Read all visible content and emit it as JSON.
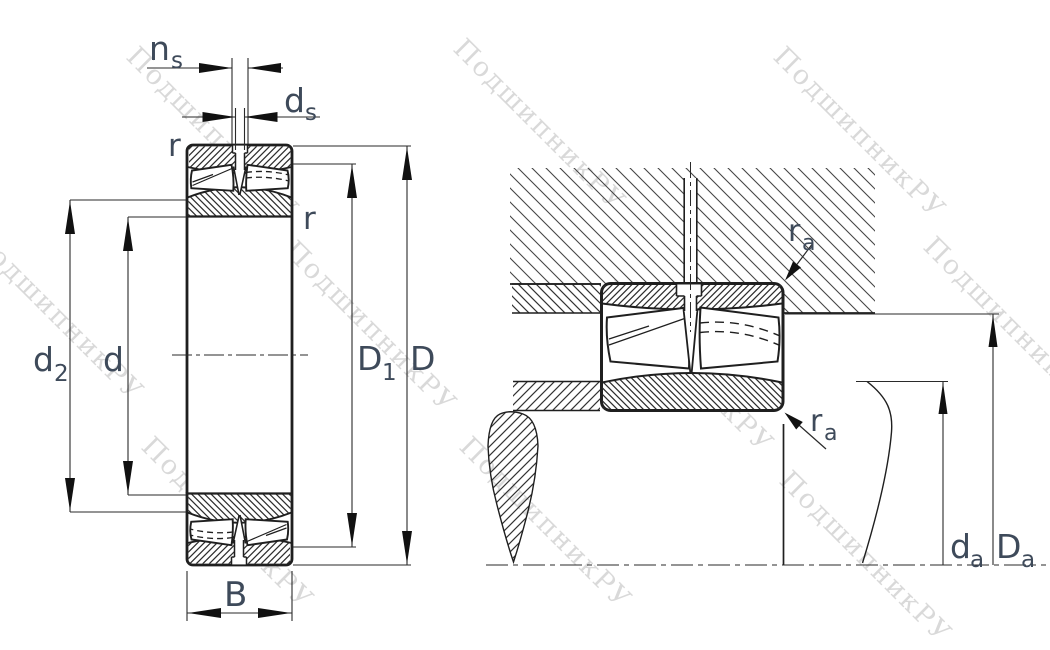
{
  "drawing": {
    "title": "Spherical roller bearing cross-section with mounting abutment dimensions",
    "watermark": {
      "text": "ПодшипникРУ",
      "color": "#b5b5b5"
    },
    "colors": {
      "background": "#ffffff",
      "outline": "#1f1f1f",
      "hatch": "#2e2e2e",
      "housing_hatch": "#454545",
      "dimension_line": "#2a2a2a",
      "arrow": "#111111",
      "label": "#3e4a5a"
    },
    "dims": {
      "ns": {
        "base": "n",
        "sub": "s"
      },
      "ds": {
        "base": "d",
        "sub": "s"
      },
      "r_top_left": {
        "base": "r"
      },
      "r_right": {
        "base": "r"
      },
      "d2": {
        "base": "d",
        "sub": "2"
      },
      "d": {
        "base": "d"
      },
      "D1": {
        "base": "D",
        "sub": "1"
      },
      "D": {
        "base": "D"
      },
      "B": {
        "base": "B"
      },
      "ra_upper": {
        "base": "r",
        "sub": "a"
      },
      "ra_lower": {
        "base": "r",
        "sub": "a"
      },
      "da": {
        "base": "d",
        "sub": "a"
      },
      "Da": {
        "base": "D",
        "sub": "a"
      }
    }
  }
}
